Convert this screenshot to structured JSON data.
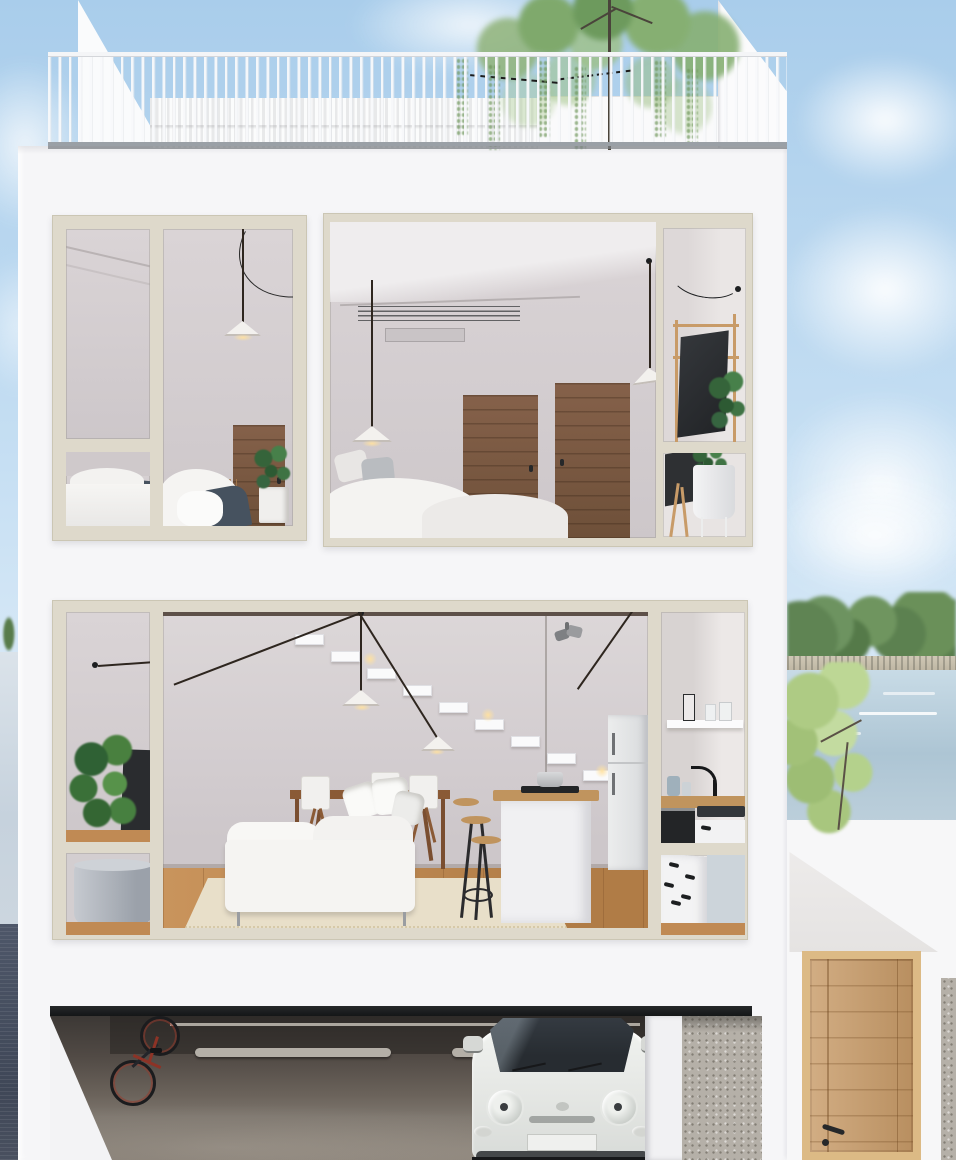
{
  "image": {
    "kind": "3d-architectural-render",
    "view": "cutaway front elevation of a three-storey modern townhouse",
    "no_visible_text": true
  },
  "scene": {
    "roof_terrace": {
      "objects": [
        "white vertical-bar railing",
        "slatted privacy screen",
        "sloped stair bulkheads",
        "terrace tree with hanging foliage"
      ]
    },
    "bedroom_floor": {
      "left_window": [
        "pendant lamp with curved black cable",
        "timber door",
        "monstera plant in white pot",
        "bed with white duvet and navy blanket"
      ],
      "right_window": [
        "ceiling air-conditioning grille",
        "two timber doors",
        "two cone pendant lamps",
        "bed with pillows and white duvet",
        "desk nook with monitor, timber ladder shelf and plant in white planter"
      ]
    },
    "living_floor": {
      "objects": [
        "fiddle-leaf plant and TV",
        "grey cylinder planter",
        "floating white staircase with step lights",
        "black multi-wire pendant lamps with white cones",
        "ceiling spotlight",
        "timber dining table with white director chairs and fruit bowl",
        "white chaise sofa with cushions",
        "kitchen island with cooktop and pot",
        "timber bar stools",
        "fridge",
        "open shelf with vase and glasses",
        "black faucet and sink",
        "oven and white cabinets",
        "timber floor with pale rug"
      ]
    },
    "garage_level": {
      "objects": [
        "dark lintel beam",
        "wall-mounted bicycle",
        "concrete floor with wheel stops",
        "white Fiat-500-style car",
        "gravel driveway"
      ]
    },
    "environment": {
      "sky": "light blue with soft clouds",
      "right": [
        "lake with far tree line and shore",
        "white boat streaks on water",
        "light-green foreground tree",
        "white neighbouring wall with cast shadow",
        "timber entry door with black handle",
        "gravel strips"
      ],
      "left": [
        "sliver of lake water",
        "small tree",
        "dark paved strip"
      ]
    }
  },
  "palette": {
    "sky1": "#a9cdeb",
    "sky2": "#c6dff3",
    "sky3": "#e9f2fa",
    "facade": "#f6f6f8",
    "frame": "#ded9cb",
    "wallA": "#dad4d6",
    "wallB": "#cdc7ca",
    "woodDoor": "#85614a",
    "woodFloor": "#c08a54",
    "woodLight": "#c89b68",
    "oak": "#dcba85",
    "counter": "#c0945e",
    "tblWood": "#8a5a36",
    "navy": "#46525f",
    "green2": "#587c4b",
    "green3": "#aecb84",
    "treeline": "#5f8453",
    "lake1": "#c8dbe6",
    "lake2": "#adc5d4",
    "shore": "#cfc8b5",
    "nwall": "#f7f7f8",
    "shadow": "#e5e3e2",
    "gravel": "#b5b0a8",
    "paving": "#4e5769",
    "car": "#e6e8e5",
    "glass": "#272c31",
    "ink": "#26282a",
    "metal": "#9aa0a6"
  }
}
